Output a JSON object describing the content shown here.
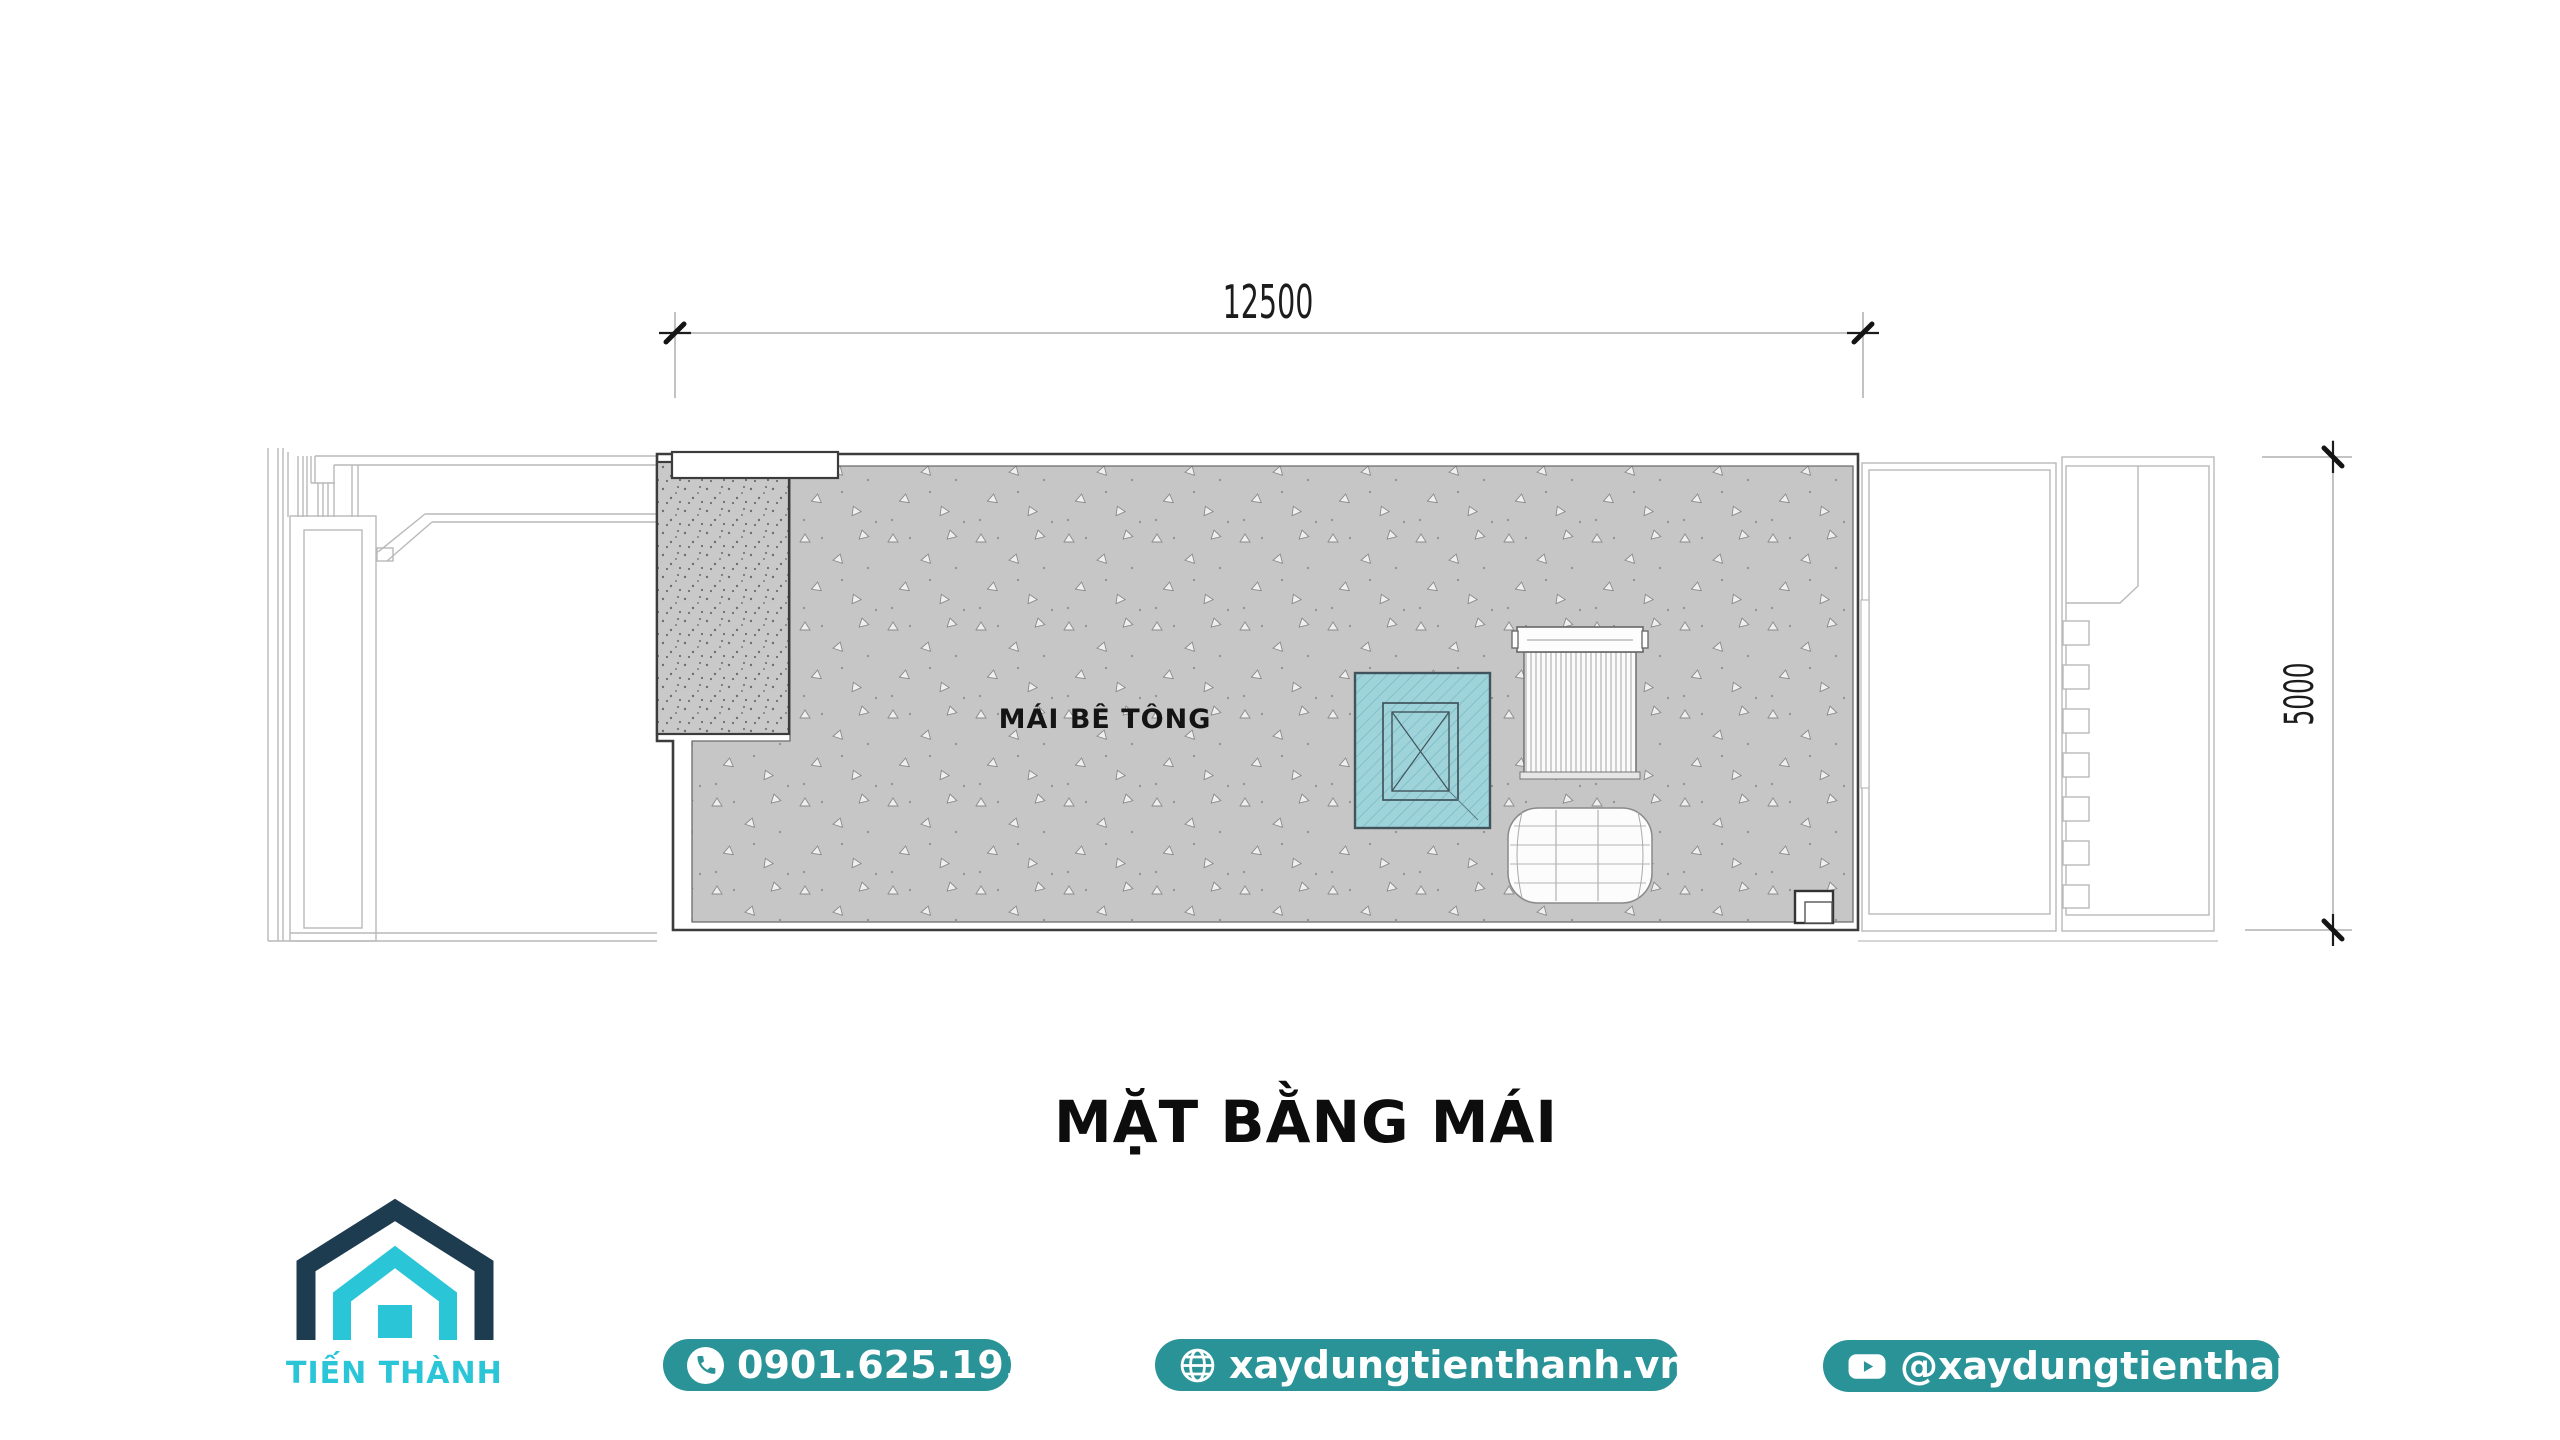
{
  "drawing": {
    "title": "MẶT BẰNG MÁI",
    "roof_label": "MÁI BÊ TÔNG",
    "dim_width": "12500",
    "dim_height": "5000",
    "elements": {
      "roof_surface": "concrete-roof",
      "skylight": "hatched-skylight",
      "water_tank": "water-tank-top-view",
      "water_heater": "horizontal-cylinder-tank"
    }
  },
  "logo": {
    "company_name": "TIẾN THÀNH",
    "icon": "house-logo-icon",
    "colors": {
      "navy": "#1e3c50",
      "cyan": "#2bc5d8"
    }
  },
  "contacts": {
    "phone": {
      "icon": "phone-icon",
      "label": "0901.625.191"
    },
    "website": {
      "icon": "globe-icon",
      "label": "xaydungtienthanh.vn"
    },
    "youtube": {
      "icon": "youtube-icon",
      "label": "@xaydungtienthanh"
    }
  },
  "colors": {
    "button_teal": "#2a9397",
    "roof_fill": "#c6c6c6",
    "gravel_fill": "#c9c9c9",
    "skylight_teal": "#9fd3da",
    "dark_line": "#3c3c3c",
    "light_line": "#b9b9b9"
  }
}
